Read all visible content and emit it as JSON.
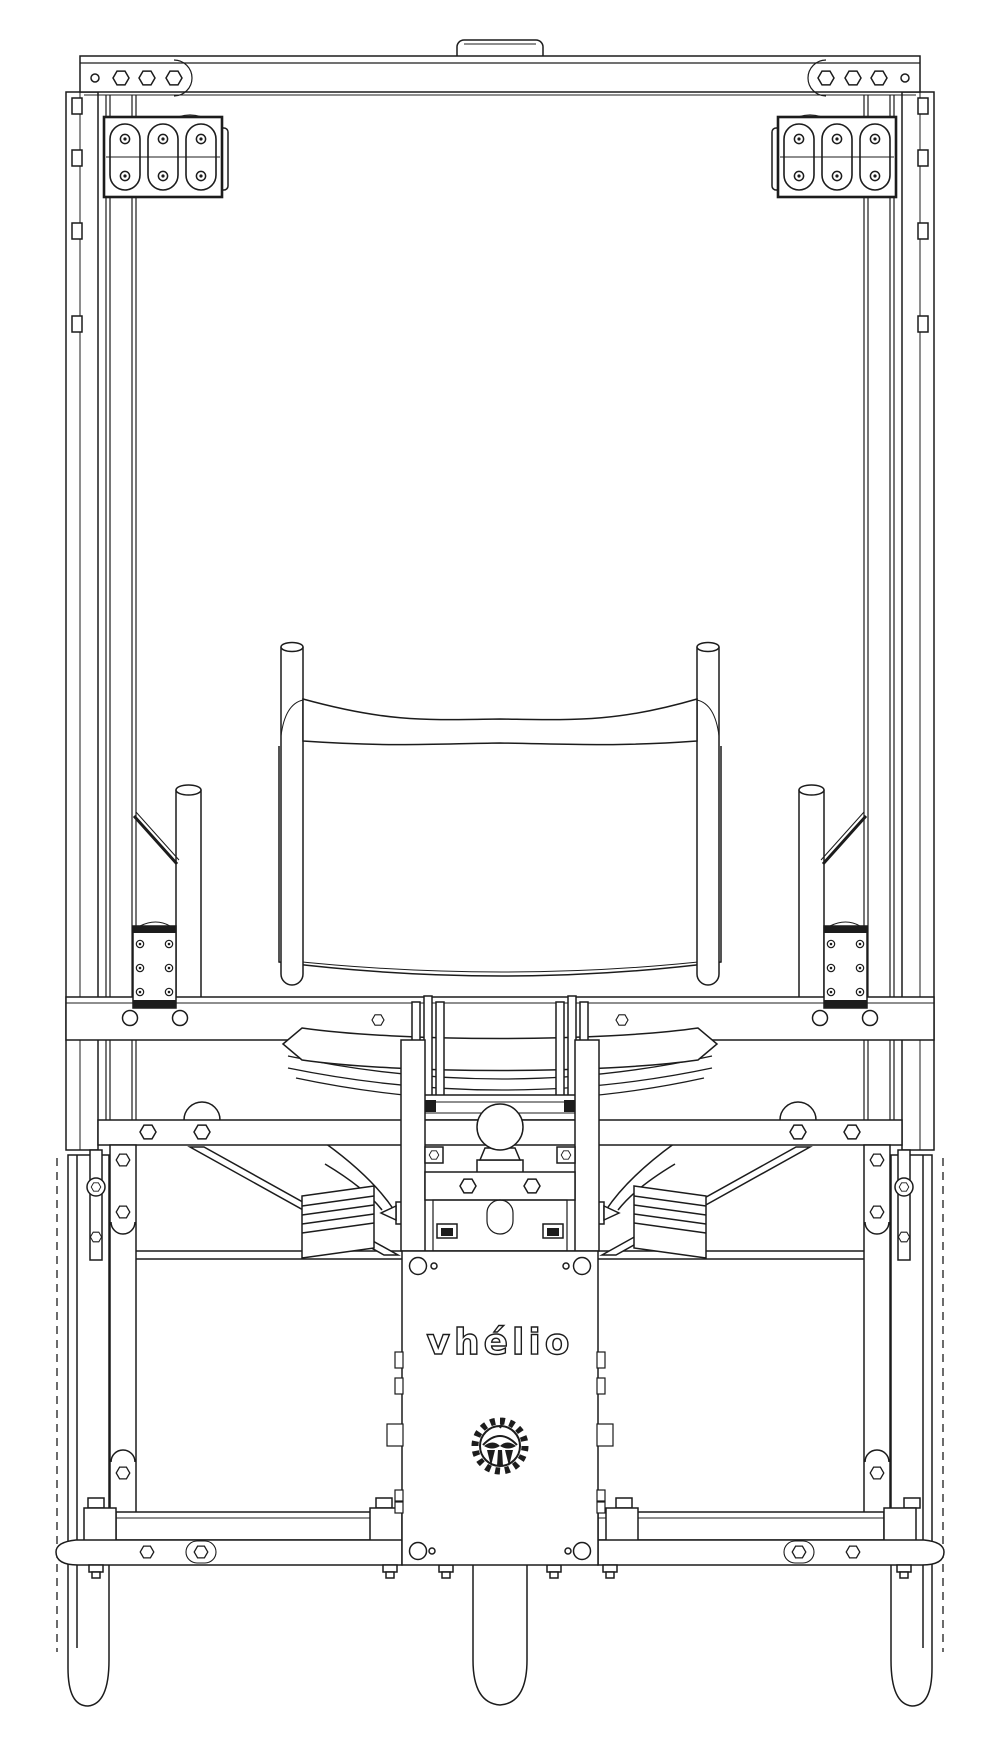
{
  "panel": {
    "brand": "vhélio"
  },
  "icons": {
    "gear_logo": "gear-tree-icon",
    "lights": "triple-lamp-cluster-icon"
  },
  "colors": {
    "line": "#1c1c1c",
    "background": "#ffffff"
  }
}
